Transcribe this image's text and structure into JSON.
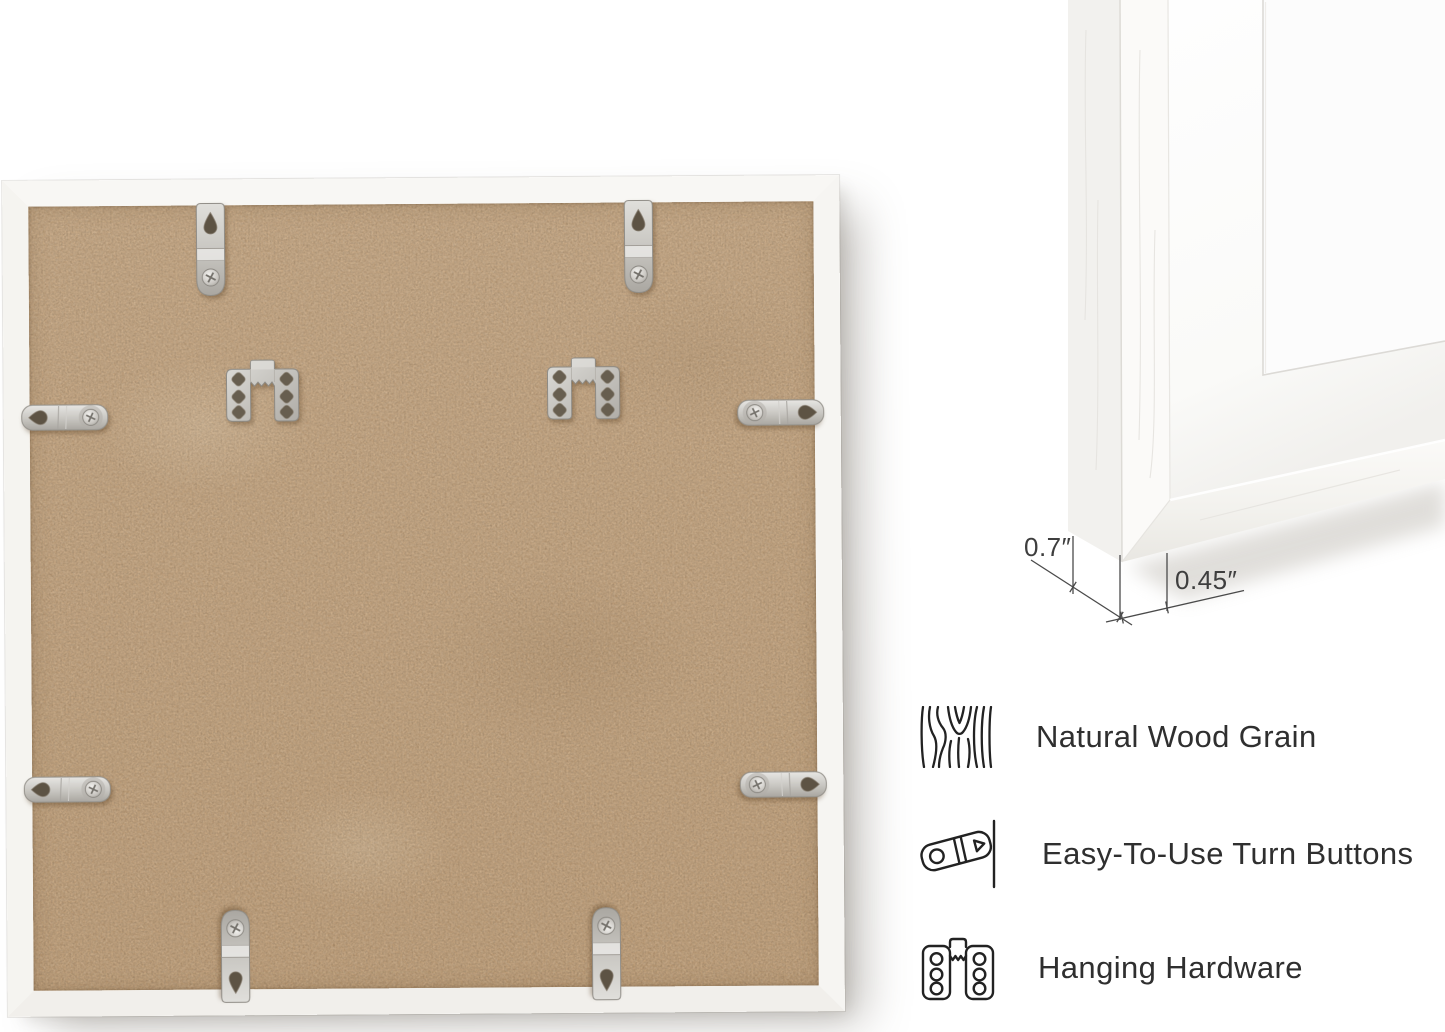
{
  "meta": {
    "description": "Product gallery image: back view of a white square picture frame with hanging hardware, frame-corner close-up with dimensions, and feature callouts",
    "background_color": "#ffffff"
  },
  "back_view_photo": {
    "frame_color": "#f7f6f3",
    "backing_color": "#cda97f",
    "hardware_finish": "silver",
    "hanger_tabs_count": 4,
    "turn_buttons_count": 4,
    "sawtooth_plates_count": 2
  },
  "corner_closeup": {
    "frame_color": "#f5f4f1",
    "mat_color": "#fdfdfd",
    "dimension_labels": {
      "depth": "0.7″",
      "face_width": "0.45″"
    }
  },
  "features": [
    {
      "icon": "wood-grain-icon",
      "label": "Natural Wood Grain"
    },
    {
      "icon": "turn-button-icon",
      "label": "Easy-To-Use Turn Buttons"
    },
    {
      "icon": "hanging-hardware-icon",
      "label": "Hanging Hardware"
    }
  ]
}
